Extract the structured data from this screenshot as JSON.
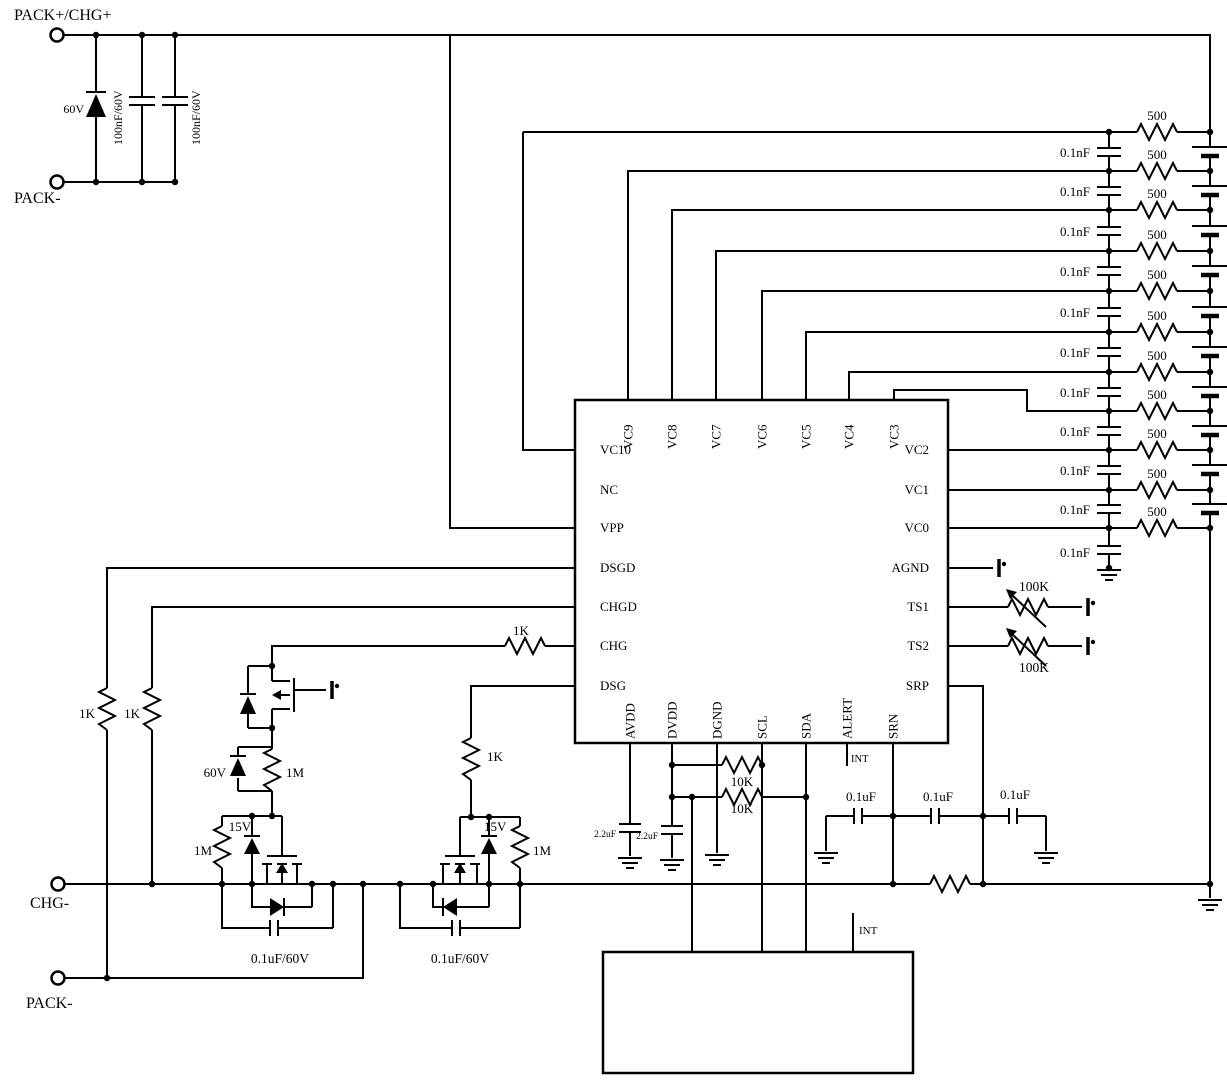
{
  "schematic": {
    "ic": {
      "name": "MT98006",
      "pins": {
        "left": [
          "VC10",
          "NC",
          "VPP",
          "DSGD",
          "CHGD",
          "CHG",
          "DSG"
        ],
        "top": [
          "VC9",
          "VC8",
          "VC7",
          "VC6",
          "VC5",
          "VC4",
          "VC3"
        ],
        "right": [
          "VC2",
          "VC1",
          "VC0",
          "AGND",
          "TS1",
          "TS2",
          "SRP"
        ],
        "bottom": [
          "AVDD",
          "DVDD",
          "DGND",
          "SCL",
          "SDA",
          "ALERT",
          "SRN"
        ]
      }
    },
    "terminals": {
      "pack_plus": "PACK+/CHG+",
      "pack_minus_top": "PACK-",
      "chg_minus": "CHG-",
      "pack_minus_bottom": "PACK-"
    },
    "input_protection": {
      "tvs": "60V",
      "cap1": "100nF/60V",
      "cap2": "100nF/60V"
    },
    "cell_network": {
      "cells": 10,
      "rows": [
        {
          "pin": "VC10",
          "res": "500",
          "cap": "0.1nF"
        },
        {
          "pin": "VC9",
          "res": "500",
          "cap": "0.1nF"
        },
        {
          "pin": "VC8",
          "res": "500",
          "cap": "0.1nF"
        },
        {
          "pin": "VC7",
          "res": "500",
          "cap": "0.1nF"
        },
        {
          "pin": "VC6",
          "res": "500",
          "cap": "0.1nF"
        },
        {
          "pin": "VC5",
          "res": "500",
          "cap": "0.1nF"
        },
        {
          "pin": "VC4",
          "res": "500",
          "cap": "0.1nF"
        },
        {
          "pin": "VC3",
          "res": "500",
          "cap": "0.1nF"
        },
        {
          "pin": "VC2",
          "res": "500",
          "cap": "0.1nF"
        },
        {
          "pin": "VC1",
          "res": "500",
          "cap": "0.1nF"
        },
        {
          "pin": "VC0",
          "res": "500",
          "cap": "0.1nF"
        }
      ]
    },
    "thermistors": {
      "ts1": "100K",
      "ts2": "100K"
    },
    "gate_drive": {
      "dsgd_res": "1K",
      "chgd_res": "1K",
      "chg_res": "1K",
      "dsg_res": "1K",
      "clamp_zener": "60V",
      "clamp_res": "1M",
      "left_fet": {
        "gate_res": "1M",
        "gate_zener": "15V",
        "snubber": "0.1uF/60V"
      },
      "right_fet": {
        "gate_res": "1M",
        "gate_zener": "15V",
        "snubber": "0.1uF/60V"
      }
    },
    "supply": {
      "avdd_cap": "2.2uF",
      "dvdd_cap": "2.2uF"
    },
    "i2c": {
      "pullup_scl": "10K",
      "pullup_sda": "10K",
      "alert_net": "INT"
    },
    "sense": {
      "cap1": "0.1uF",
      "cap2": "0.1uF",
      "cap3": "0.1uF"
    },
    "mcu": {
      "name": "MCU",
      "pin_vcc": "VCC",
      "pin_sda": "SDA",
      "pin_scl": "SCL",
      "pin_int": "INT",
      "int_net": "INT"
    }
  }
}
